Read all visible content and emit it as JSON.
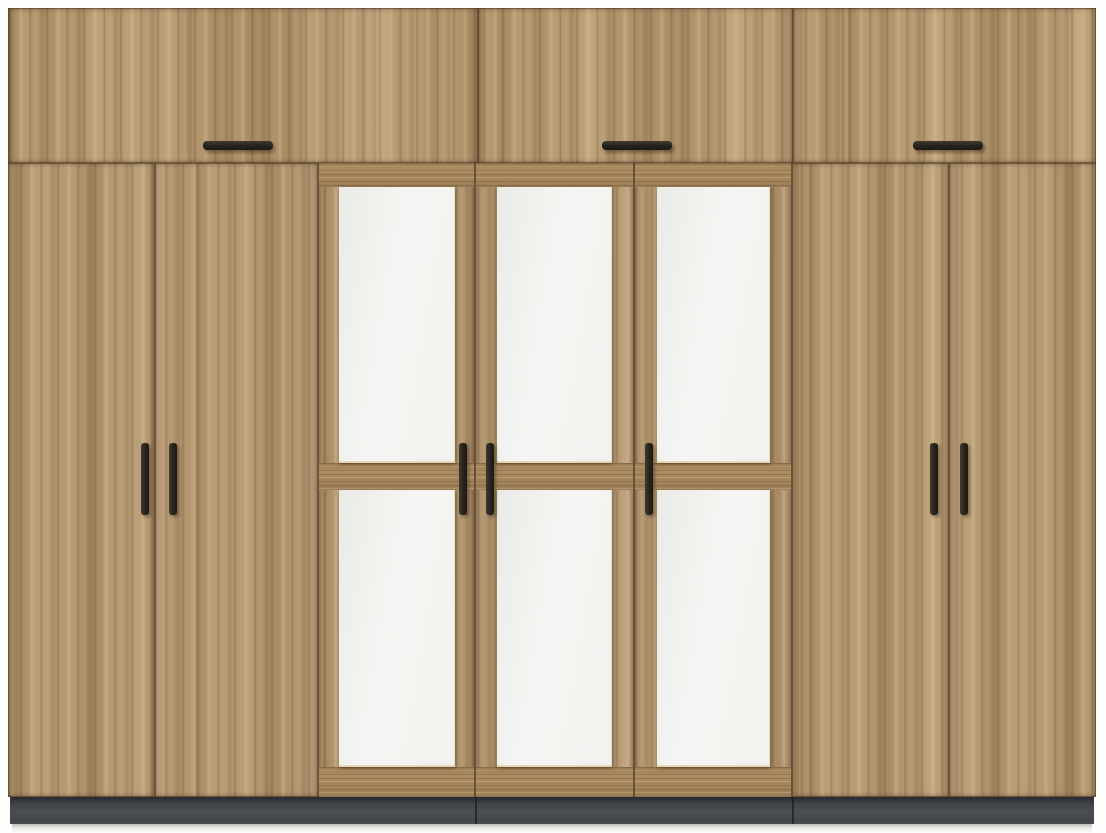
{
  "palette": {
    "background": "#fdfdfc",
    "wood_base": "#b6986f",
    "wood_dark_streak": "#5a3f24",
    "wood_light_streak": "#dfc7a0",
    "seam_brown": "#4a361f",
    "panel_white": "#f4f4f2",
    "panel_edge_cream": "#e5d5b4",
    "handle_black": "#26221c",
    "plinth_gray": "#4b4e53",
    "plinth_joint_dark": "#121417",
    "floor_shadow_gray": "#918e88"
  },
  "wardrobe": {
    "x": 8,
    "y": 8,
    "width": 1088,
    "height": 816,
    "top_row": {
      "y": 0,
      "height": 155,
      "doors": [
        {
          "id": "top-door-1",
          "x": 0,
          "width": 470,
          "shift": 0
        },
        {
          "id": "top-door-2",
          "x": 470,
          "width": 315,
          "shift": 23
        },
        {
          "id": "top-door-3",
          "x": 785,
          "width": 303,
          "shift": 55
        }
      ],
      "handles": [
        {
          "id": "top-door-1-handle",
          "x": 195,
          "y": 133,
          "width": 70,
          "height": 9
        },
        {
          "id": "top-door-2-handle",
          "x": 594,
          "y": 133,
          "width": 70,
          "height": 9
        },
        {
          "id": "top-door-3-handle",
          "x": 905,
          "y": 133,
          "width": 70,
          "height": 9
        }
      ]
    },
    "main_row": {
      "y": 155,
      "height": 634,
      "doors": [
        {
          "id": "left-door-1",
          "x": 0,
          "width": 147,
          "shift": 11
        },
        {
          "id": "left-door-2",
          "x": 147,
          "width": 163,
          "shift": 41
        },
        {
          "id": "middle-door-1",
          "x": 310,
          "width": 157,
          "shift": 5,
          "panels": {
            "inset_left": 21,
            "width": 116
          }
        },
        {
          "id": "middle-door-2",
          "x": 467,
          "width": 159,
          "shift": 29,
          "panels": {
            "inset_left": 22,
            "width": 115
          }
        },
        {
          "id": "middle-door-3",
          "x": 626,
          "width": 158,
          "shift": 63,
          "panels": {
            "inset_left": 23,
            "width": 113
          }
        },
        {
          "id": "right-door-1",
          "x": 784,
          "width": 157,
          "shift": 17
        },
        {
          "id": "right-door-2",
          "x": 941,
          "width": 147,
          "shift": 47
        }
      ],
      "handles": [
        {
          "id": "left-door-1-handle",
          "x": 133,
          "y": 435,
          "width": 8,
          "height": 72
        },
        {
          "id": "left-door-2-handle",
          "x": 161,
          "y": 435,
          "width": 8,
          "height": 72
        },
        {
          "id": "middle-door-1-handle",
          "x": 451,
          "y": 435,
          "width": 8,
          "height": 72
        },
        {
          "id": "middle-door-2-handle",
          "x": 478,
          "y": 435,
          "width": 8,
          "height": 72
        },
        {
          "id": "middle-door-3-handle",
          "x": 637,
          "y": 435,
          "width": 8,
          "height": 72
        },
        {
          "id": "right-door-1-handle",
          "x": 922,
          "y": 435,
          "width": 8,
          "height": 72
        },
        {
          "id": "right-door-2-handle",
          "x": 952,
          "y": 435,
          "width": 8,
          "height": 72
        }
      ]
    },
    "middle_door_detail": {
      "rails": [
        {
          "id": "top-rail",
          "y": 0,
          "height": 24
        },
        {
          "id": "middle-rail",
          "y": 300,
          "height": 27
        },
        {
          "id": "bottom-rail",
          "y": 604,
          "height": 30
        }
      ],
      "upper_panel": {
        "y": 24,
        "height": 276
      },
      "lower_panel": {
        "y": 327,
        "height": 277
      }
    },
    "plinth": {
      "x": 2,
      "y": 789,
      "width": 1084,
      "height": 27,
      "joints": [
        467,
        784
      ]
    },
    "floor_shadow": {
      "x": 4,
      "y": 816,
      "width": 1080,
      "height": 9
    }
  }
}
